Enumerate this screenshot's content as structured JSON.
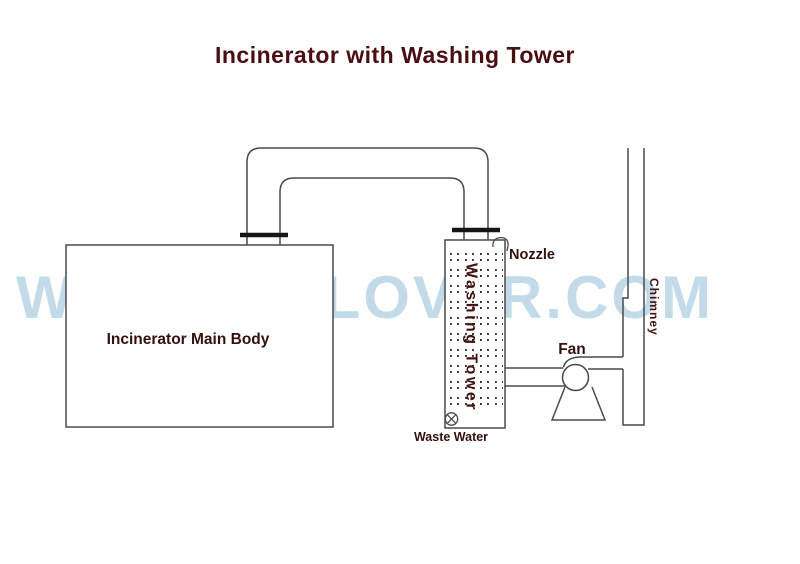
{
  "title": "Incinerator with Washing Tower",
  "watermark": {
    "text": "WWW.HICLOVER.COM",
    "color": "#c3dbe9"
  },
  "labels": {
    "incinerator": "Incinerator Main Body",
    "washing_tower": "Washing Tower",
    "nozzle": "Nozzle",
    "fan": "Fan",
    "waste_water": "Waste Water",
    "chimney": "Chimney"
  },
  "colors": {
    "title_text": "#4a0d12",
    "label_text": "#33100f",
    "vertical_label_text": "#421310",
    "diagram_line": "#4a4a4a",
    "flange_line": "#161616",
    "watermark": "#c3dbe9",
    "background": "#ffffff"
  }
}
